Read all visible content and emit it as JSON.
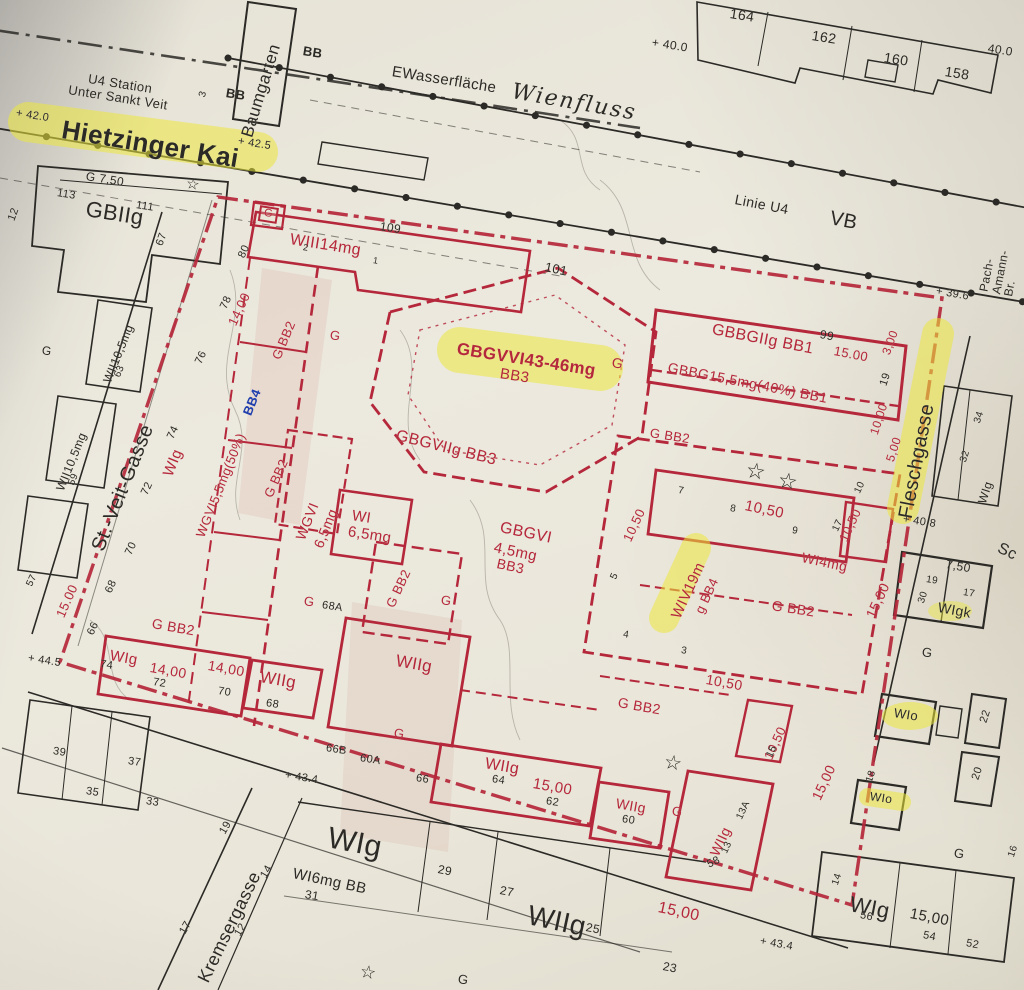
{
  "streets": {
    "hietzinger_kai": "Hietzinger Kai",
    "st_veit_gasse": "St.-Veit-Gasse",
    "fleschgasse": "Fleschgasse",
    "kremsergasse": "Kremsergasse"
  },
  "transit": {
    "u4_station": "U4 Station\nUnter Sankt Veit",
    "linie_u4": "Linie U4",
    "vb": "VB",
    "bb": "BB",
    "baumgarten": "Baumgarten",
    "pach_amann_br": "Pach-Amann-Br.",
    "sc": "Sc"
  },
  "water": {
    "wasserflaeche": "EWasserfläche",
    "wienfluss": "Wienfluss"
  },
  "zones": {
    "gbiig": "GBIIg",
    "g_750": "G  7,50",
    "g": "G",
    "wii105mg": "WII10,5mg",
    "wiii14mg": "WIII14mg",
    "g_bb2": "G BB2",
    "gbgvvi_43_46mg": "GBGVVI43-46mg",
    "bb3": "BB3",
    "gbgviig_bb3": "GBGVIIg BB3",
    "gbbgiig_bb1": "GBBGIIg BB1",
    "gbbg_155mg_40_bb1": "GBBG15,5mg(40%) BB1",
    "wgvi_55mg_50": "WGVI5,5mg(50%)",
    "bb4": "BB4",
    "wgvi": "WGVI",
    "v65mg": "6,5mg",
    "wi": "WI",
    "gbgvi": "GBGVI",
    "v45mg": "4,5mg",
    "wiv19m": "WIV19m",
    "g_bb4": "g BB4",
    "wi4mg": "WI4mg",
    "wig": "WIg",
    "wiig": "WIIg",
    "wigk": "WIgk",
    "wio": "WIo",
    "wi6mg_bb": "WI6mg BB"
  },
  "dims": {
    "d300": "3,00",
    "d500": "5,00",
    "d750": "7,50",
    "d1000": "10,00",
    "d1050": "10,50",
    "d1400": "14,00",
    "d1500": "15,00",
    "d1500d": "15.00"
  },
  "elev": {
    "e420": "+ 42.0",
    "e425": "+ 42.5",
    "e400": "+ 40.0",
    "e400r": "40.0",
    "e396": "+ 39.6",
    "e408": "+ 40.8",
    "e445": "+ 44.5",
    "e434": "+ 43.4"
  },
  "nums": {
    "n1": "1",
    "n2": "2",
    "n3": "3",
    "n4": "4",
    "n5": "5",
    "n7": "7",
    "n8": "8",
    "n9": "9",
    "n10": "10",
    "n12": "12",
    "n13": "13",
    "n13a": "13A",
    "n14": "14",
    "n15": "15",
    "n16": "16",
    "n17": "17",
    "n18": "18",
    "n19": "19",
    "n20": "20",
    "n22": "22",
    "n23": "23",
    "n25": "25",
    "n27": "27",
    "n29": "29",
    "n30": "30",
    "n31": "31",
    "n32": "32",
    "n33": "33",
    "n34": "34",
    "n35": "35",
    "n37": "37",
    "n39": "39",
    "n52": "52",
    "n54": "54",
    "n56": "56",
    "n57": "57",
    "n58": "58",
    "n59": "59",
    "n60": "60",
    "n60a": "60A",
    "n62": "62",
    "n63": "63",
    "n64": "64",
    "n66": "66",
    "n66b": "66B",
    "n67": "67",
    "n68": "68",
    "n68a": "68A",
    "n70": "70",
    "n72": "72",
    "n74": "74",
    "n76": "76",
    "n78": "78",
    "n80": "80",
    "n99": "99",
    "n101": "101",
    "n109": "109",
    "n111": "111",
    "n113": "113",
    "n158": "158",
    "n160": "160",
    "n162": "162",
    "n164": "164"
  },
  "symbols": {
    "star": "☆"
  },
  "colors": {
    "boundary_red": "#b5273a",
    "ink_black": "#2b2a26",
    "bb4_blue": "#1f3fae",
    "highlighter_yellow": "#ece73c",
    "paper": "#eae6da"
  }
}
